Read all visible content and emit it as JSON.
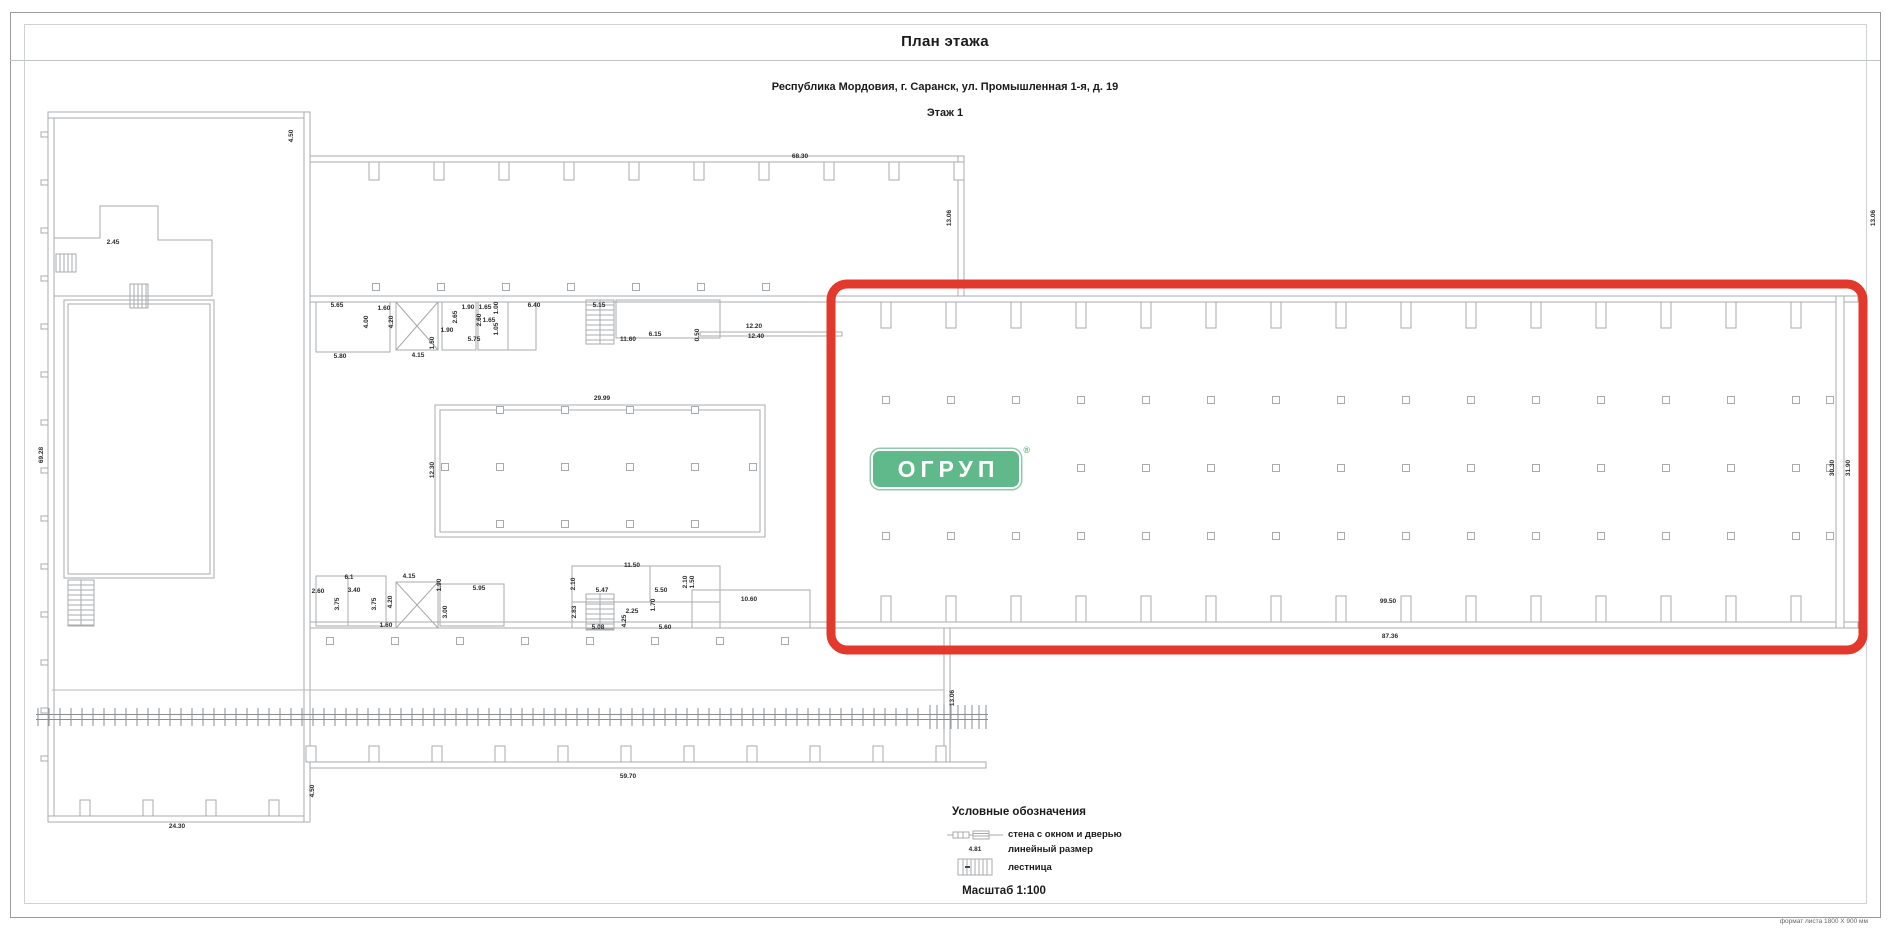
{
  "sheet": {
    "title": "План этажа",
    "address": "Республика Мордовия, г. Саранск, ул. Промышленная 1-я, д. 19",
    "floor": "Этаж 1",
    "format_note": "формат листа 1800 Х 900 мм"
  },
  "logo": {
    "text": "ОГРУП",
    "reg": "®",
    "bg_color": "#5FB98A",
    "text_color": "#ffffff"
  },
  "highlight": {
    "color": "#E3392C"
  },
  "plan": {
    "wall_color": "#a8abad",
    "rail_color": "#8a8d8f"
  },
  "legend": {
    "title": "Условные обозначения",
    "items": [
      {
        "symbol": "wall-window-door",
        "label": "стена с окном и дверью"
      },
      {
        "symbol": "linear-dimension",
        "label": "линейный размер",
        "sample": "4.81"
      },
      {
        "symbol": "stairs",
        "label": "лестница"
      }
    ],
    "scale": "Масштаб 1:100"
  },
  "dimensions": [
    {
      "t": "68.30",
      "x": 800,
      "y": 157
    },
    {
      "t": "4.50",
      "x": 292,
      "y": 136,
      "r": 1
    },
    {
      "t": "13.06",
      "x": 950,
      "y": 218,
      "r": 1
    },
    {
      "t": "13.06",
      "x": 1874,
      "y": 218,
      "r": 1
    },
    {
      "t": "2.45",
      "x": 113,
      "y": 243
    },
    {
      "t": "69.28",
      "x": 42,
      "y": 455,
      "r": 1
    },
    {
      "t": "24.30",
      "x": 177,
      "y": 827
    },
    {
      "t": "4.50",
      "x": 313,
      "y": 791,
      "r": 1
    },
    {
      "t": "59.70",
      "x": 628,
      "y": 777
    },
    {
      "t": "13.06",
      "x": 953,
      "y": 698,
      "r": 1
    },
    {
      "t": "99.50",
      "x": 1388,
      "y": 602
    },
    {
      "t": "87.36",
      "x": 1390,
      "y": 637
    },
    {
      "t": "30.30",
      "x": 1833,
      "y": 468,
      "r": 1
    },
    {
      "t": "31.90",
      "x": 1849,
      "y": 468,
      "r": 1
    },
    {
      "t": "29.99",
      "x": 602,
      "y": 399
    },
    {
      "t": "12.30",
      "x": 433,
      "y": 470,
      "r": 1
    },
    {
      "t": "5.65",
      "x": 337,
      "y": 306
    },
    {
      "t": "4.00",
      "x": 367,
      "y": 322,
      "r": 1
    },
    {
      "t": "5.80",
      "x": 340,
      "y": 357
    },
    {
      "t": "1.60",
      "x": 384,
      "y": 309
    },
    {
      "t": "4.20",
      "x": 392,
      "y": 322,
      "r": 1
    },
    {
      "t": "4.15",
      "x": 418,
      "y": 356
    },
    {
      "t": "1.90",
      "x": 468,
      "y": 308
    },
    {
      "t": "1.90",
      "x": 447,
      "y": 331
    },
    {
      "t": "2.65",
      "x": 456,
      "y": 317,
      "r": 1
    },
    {
      "t": "1.50",
      "x": 433,
      "y": 343,
      "r": 1
    },
    {
      "t": "5.75",
      "x": 474,
      "y": 340
    },
    {
      "t": "1.65",
      "x": 485,
      "y": 308
    },
    {
      "t": "1.00",
      "x": 497,
      "y": 308,
      "r": 1
    },
    {
      "t": "2.60",
      "x": 480,
      "y": 320,
      "r": 1
    },
    {
      "t": "1.65",
      "x": 489,
      "y": 321
    },
    {
      "t": "1.05",
      "x": 497,
      "y": 329,
      "r": 1
    },
    {
      "t": "6.40",
      "x": 534,
      "y": 306
    },
    {
      "t": "5.15",
      "x": 599,
      "y": 306
    },
    {
      "t": "11.60",
      "x": 628,
      "y": 340
    },
    {
      "t": "6.15",
      "x": 655,
      "y": 335
    },
    {
      "t": "0.50",
      "x": 698,
      "y": 335,
      "r": 1
    },
    {
      "t": "12.20",
      "x": 754,
      "y": 327
    },
    {
      "t": "12.40",
      "x": 756,
      "y": 337
    },
    {
      "t": "2.60",
      "x": 318,
      "y": 592
    },
    {
      "t": "6.1",
      "x": 349,
      "y": 578
    },
    {
      "t": "3.40",
      "x": 354,
      "y": 591
    },
    {
      "t": "3.75",
      "x": 338,
      "y": 604,
      "r": 1
    },
    {
      "t": "3.75",
      "x": 375,
      "y": 604,
      "r": 1
    },
    {
      "t": "4.15",
      "x": 409,
      "y": 577
    },
    {
      "t": "4.20",
      "x": 391,
      "y": 602,
      "r": 1
    },
    {
      "t": "1.60",
      "x": 386,
      "y": 626
    },
    {
      "t": "1.90",
      "x": 440,
      "y": 585,
      "r": 1
    },
    {
      "t": "3.00",
      "x": 446,
      "y": 612,
      "r": 1
    },
    {
      "t": "5.95",
      "x": 479,
      "y": 589
    },
    {
      "t": "11.50",
      "x": 632,
      "y": 566
    },
    {
      "t": "2.10",
      "x": 574,
      "y": 584,
      "r": 1
    },
    {
      "t": "5.47",
      "x": 602,
      "y": 591
    },
    {
      "t": "2.83",
      "x": 575,
      "y": 612,
      "r": 1
    },
    {
      "t": "5.08",
      "x": 598,
      "y": 628
    },
    {
      "t": "4.25",
      "x": 625,
      "y": 621,
      "r": 1
    },
    {
      "t": "2.25",
      "x": 632,
      "y": 612
    },
    {
      "t": "1.70",
      "x": 654,
      "y": 605,
      "r": 1
    },
    {
      "t": "5.50",
      "x": 661,
      "y": 591
    },
    {
      "t": "5.60",
      "x": 665,
      "y": 628
    },
    {
      "t": "2.10",
      "x": 686,
      "y": 582,
      "r": 1
    },
    {
      "t": "1.50",
      "x": 693,
      "y": 582,
      "r": 1
    },
    {
      "t": "10.60",
      "x": 749,
      "y": 600
    }
  ]
}
